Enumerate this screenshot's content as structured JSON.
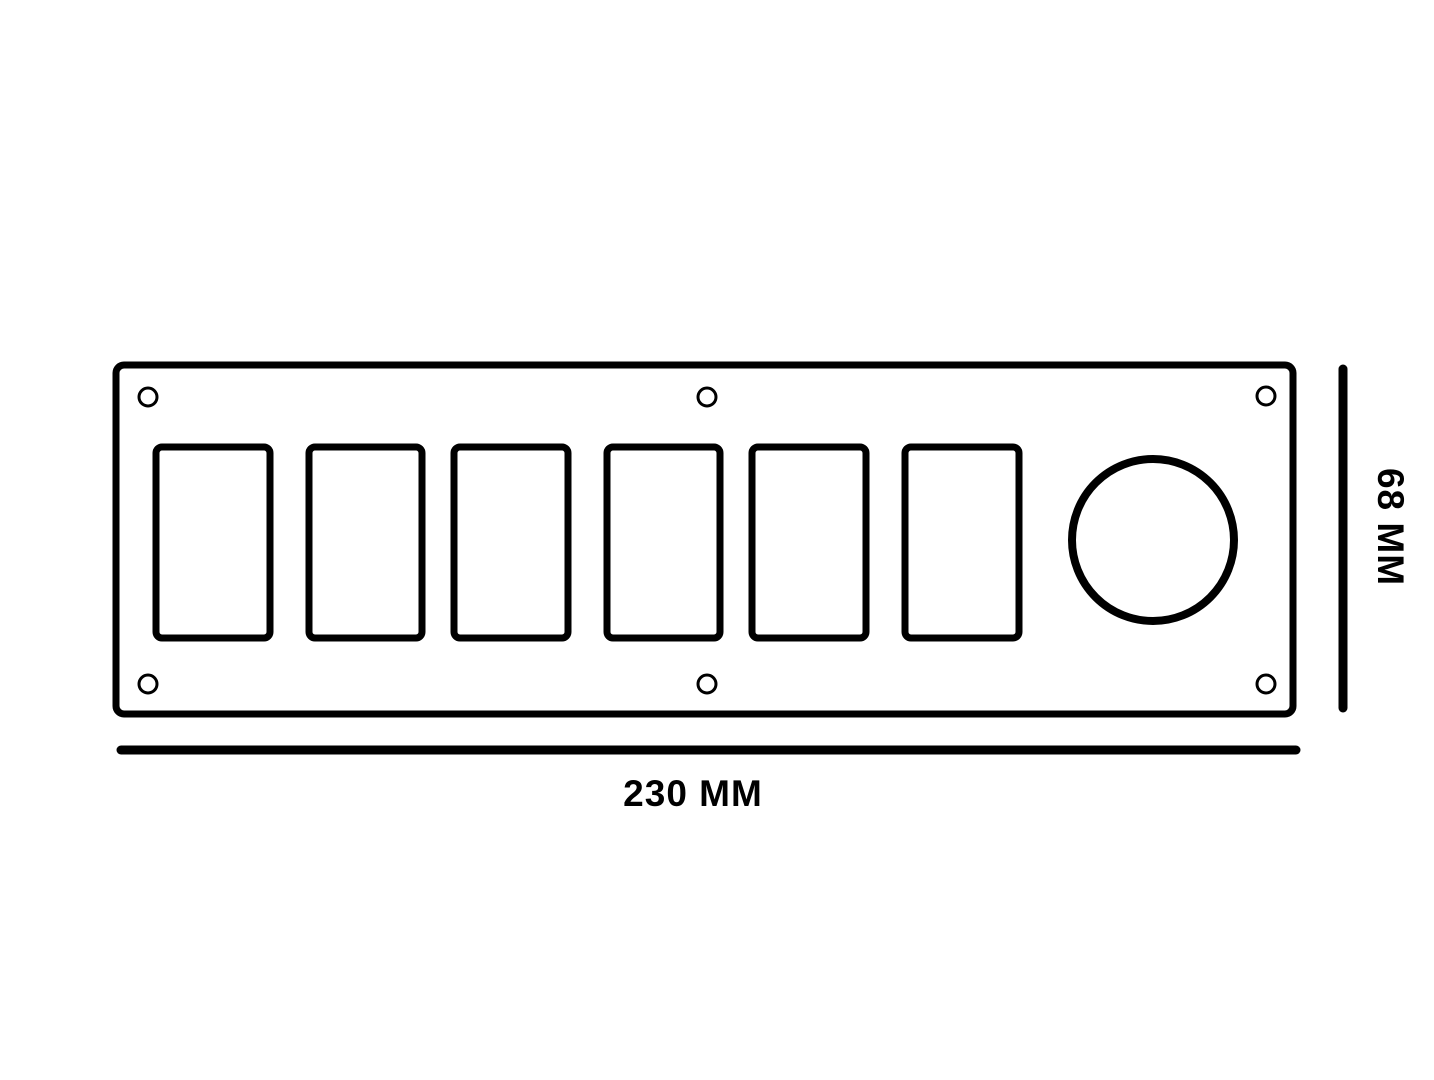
{
  "drawing": {
    "labels": {
      "width": "230 MM",
      "height": "68 MM"
    },
    "colors": {
      "line": "#000000",
      "background": "#ffffff"
    },
    "counts": {
      "switch_cutouts": 6,
      "screw_holes": 6,
      "round_holes": 1
    }
  }
}
